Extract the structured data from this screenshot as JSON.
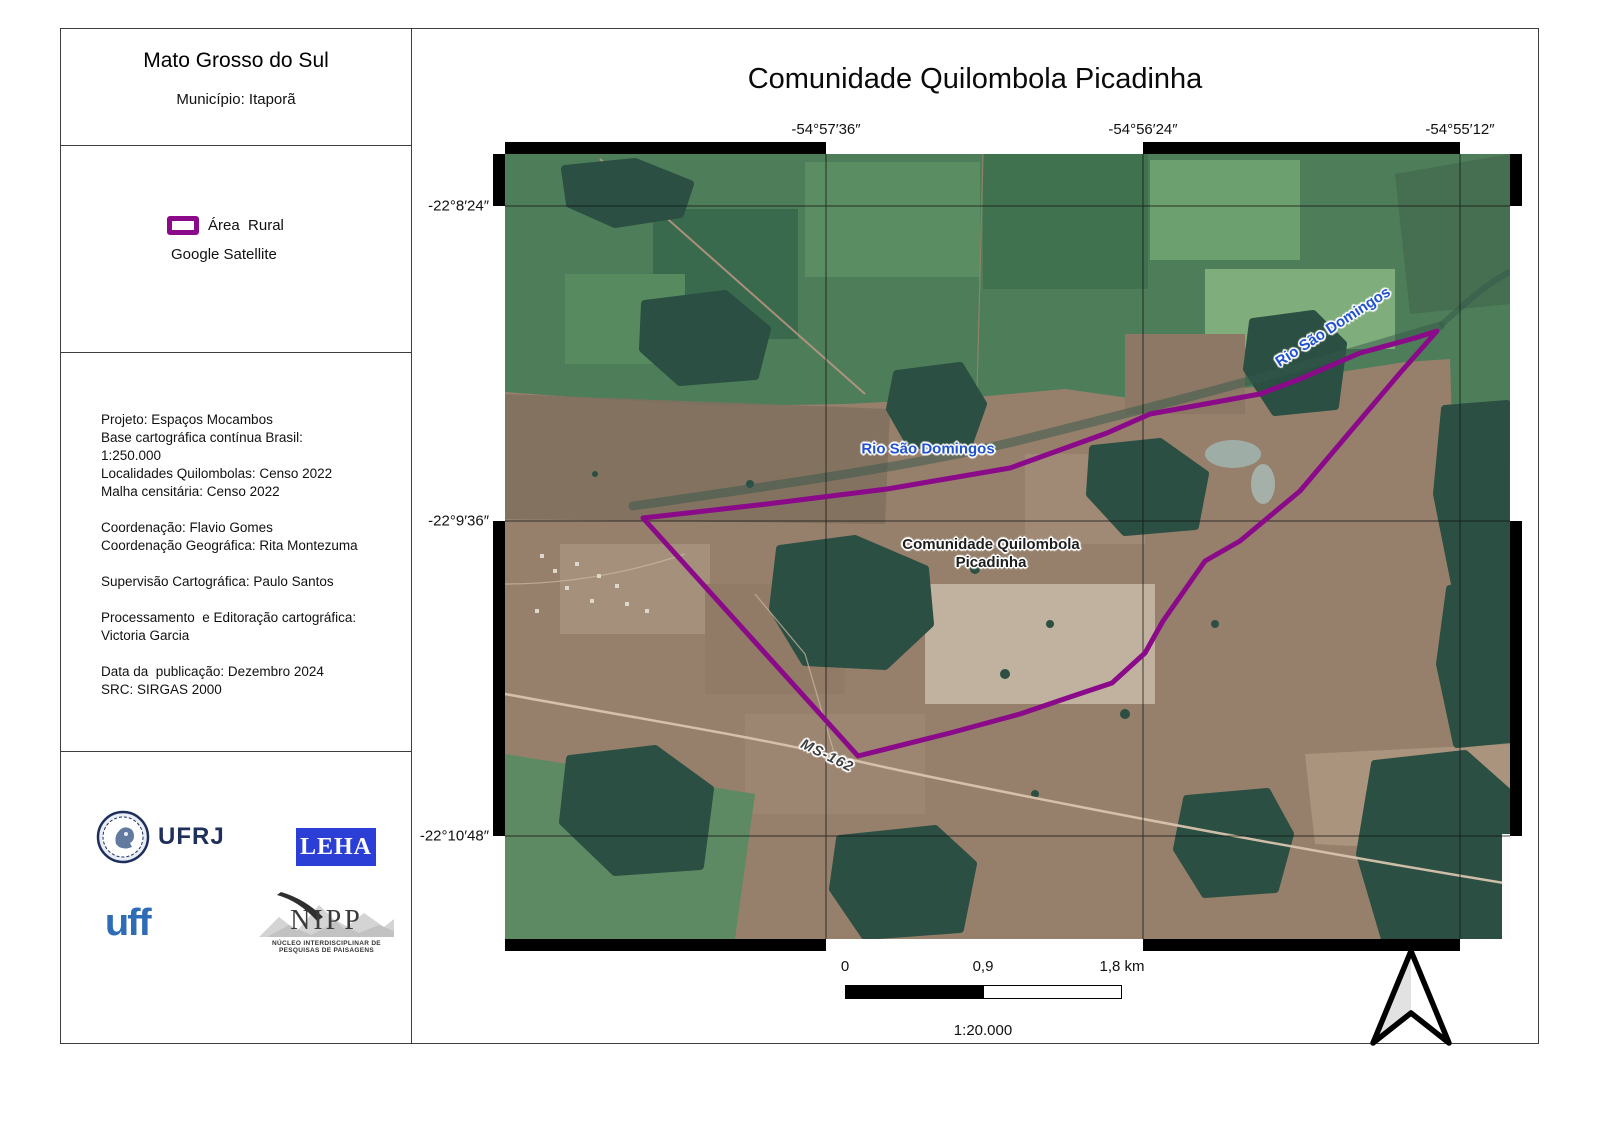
{
  "colors": {
    "boundary": "#8a0a8a",
    "leha-blue": "#2b3fd6",
    "uff-blue": "#2e6cb5",
    "ufrj-navy": "#1e2f5c",
    "river-label": "#2051cf"
  },
  "sidebar": {
    "state_title": "Mato Grosso do Sul",
    "municipality": "Município: Itaporã",
    "legend": {
      "area_label": "Área  Rural",
      "basemap_label": "Google Satellite"
    },
    "credits": {
      "lines": [
        "Projeto: Espaços Mocambos",
        "Base cartográfica contínua Brasil:",
        "1:250.000",
        "Localidades Quilombolas: Censo 2022",
        "Malha censitária: Censo 2022",
        "",
        "Coordenação: Flavio Gomes",
        "Coordenação Geográfica: Rita Montezuma",
        "",
        "Supervisão Cartográfica: Paulo Santos",
        "",
        "Processamento  e Editoração cartográfica:",
        "Victoria Garcia",
        "",
        "Data da  publicação: Dezembro 2024",
        "SRC: SIRGAS 2000"
      ]
    },
    "logos": {
      "ufrj": "UFRJ",
      "leha": "LEHA",
      "uff": "uff",
      "nipp": "NIPP",
      "nipp_subtitle": "NÚCLEO INTERDISCIPLINAR DE PESQUISAS DE PAISAGENS"
    }
  },
  "map": {
    "title": "Comunidade Quilombola Picadinha",
    "grid": {
      "lon_labels": [
        "-54°57′36″",
        "-54°56′24″",
        "-54°55′12″"
      ],
      "lat_labels": [
        "-22°8′24″",
        "-22°9′36″",
        "-22°10′48″"
      ]
    },
    "labels": {
      "river_mid": "Rio São Domingos",
      "river_ne": "Rio São Domingos",
      "community": "Comunidade Quilombola\nPicadinha",
      "road": "MS-162"
    },
    "scalebar": {
      "tick0": "0",
      "tick1": "0,9",
      "tick2": "1,8 km",
      "scale_ratio": "1:20.000"
    }
  }
}
